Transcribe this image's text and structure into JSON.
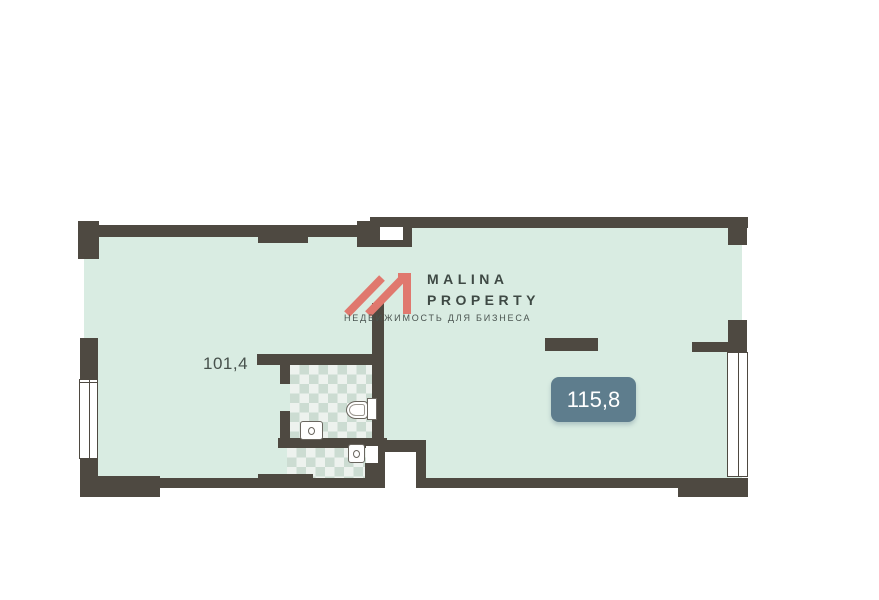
{
  "floor_plan": {
    "rooms": [
      {
        "name": "left-room",
        "area_label": "101,4"
      },
      {
        "name": "right-room",
        "area_label": "115,8"
      }
    ],
    "fixtures": [
      "toilet",
      "sink",
      "sink"
    ]
  },
  "logo": {
    "line1": "MALINA",
    "line2": "PROPERTY",
    "tagline": "НЕДВИЖИМОСТЬ ДЛЯ БИЗНЕСА"
  },
  "theme": {
    "wall_color": "#4e4941",
    "floor_color": "#d9ece2",
    "tile_dark": "#ccdcd2",
    "tile_light": "#edf2ee",
    "badge_color": "#5e7d8d",
    "badge_text_color": "#ffffff",
    "logo_red": "#e0786e",
    "logo_text_color": "#3e4944",
    "tagline_color": "#4a5450",
    "label_color": "#47514c",
    "background": "#ffffff"
  }
}
